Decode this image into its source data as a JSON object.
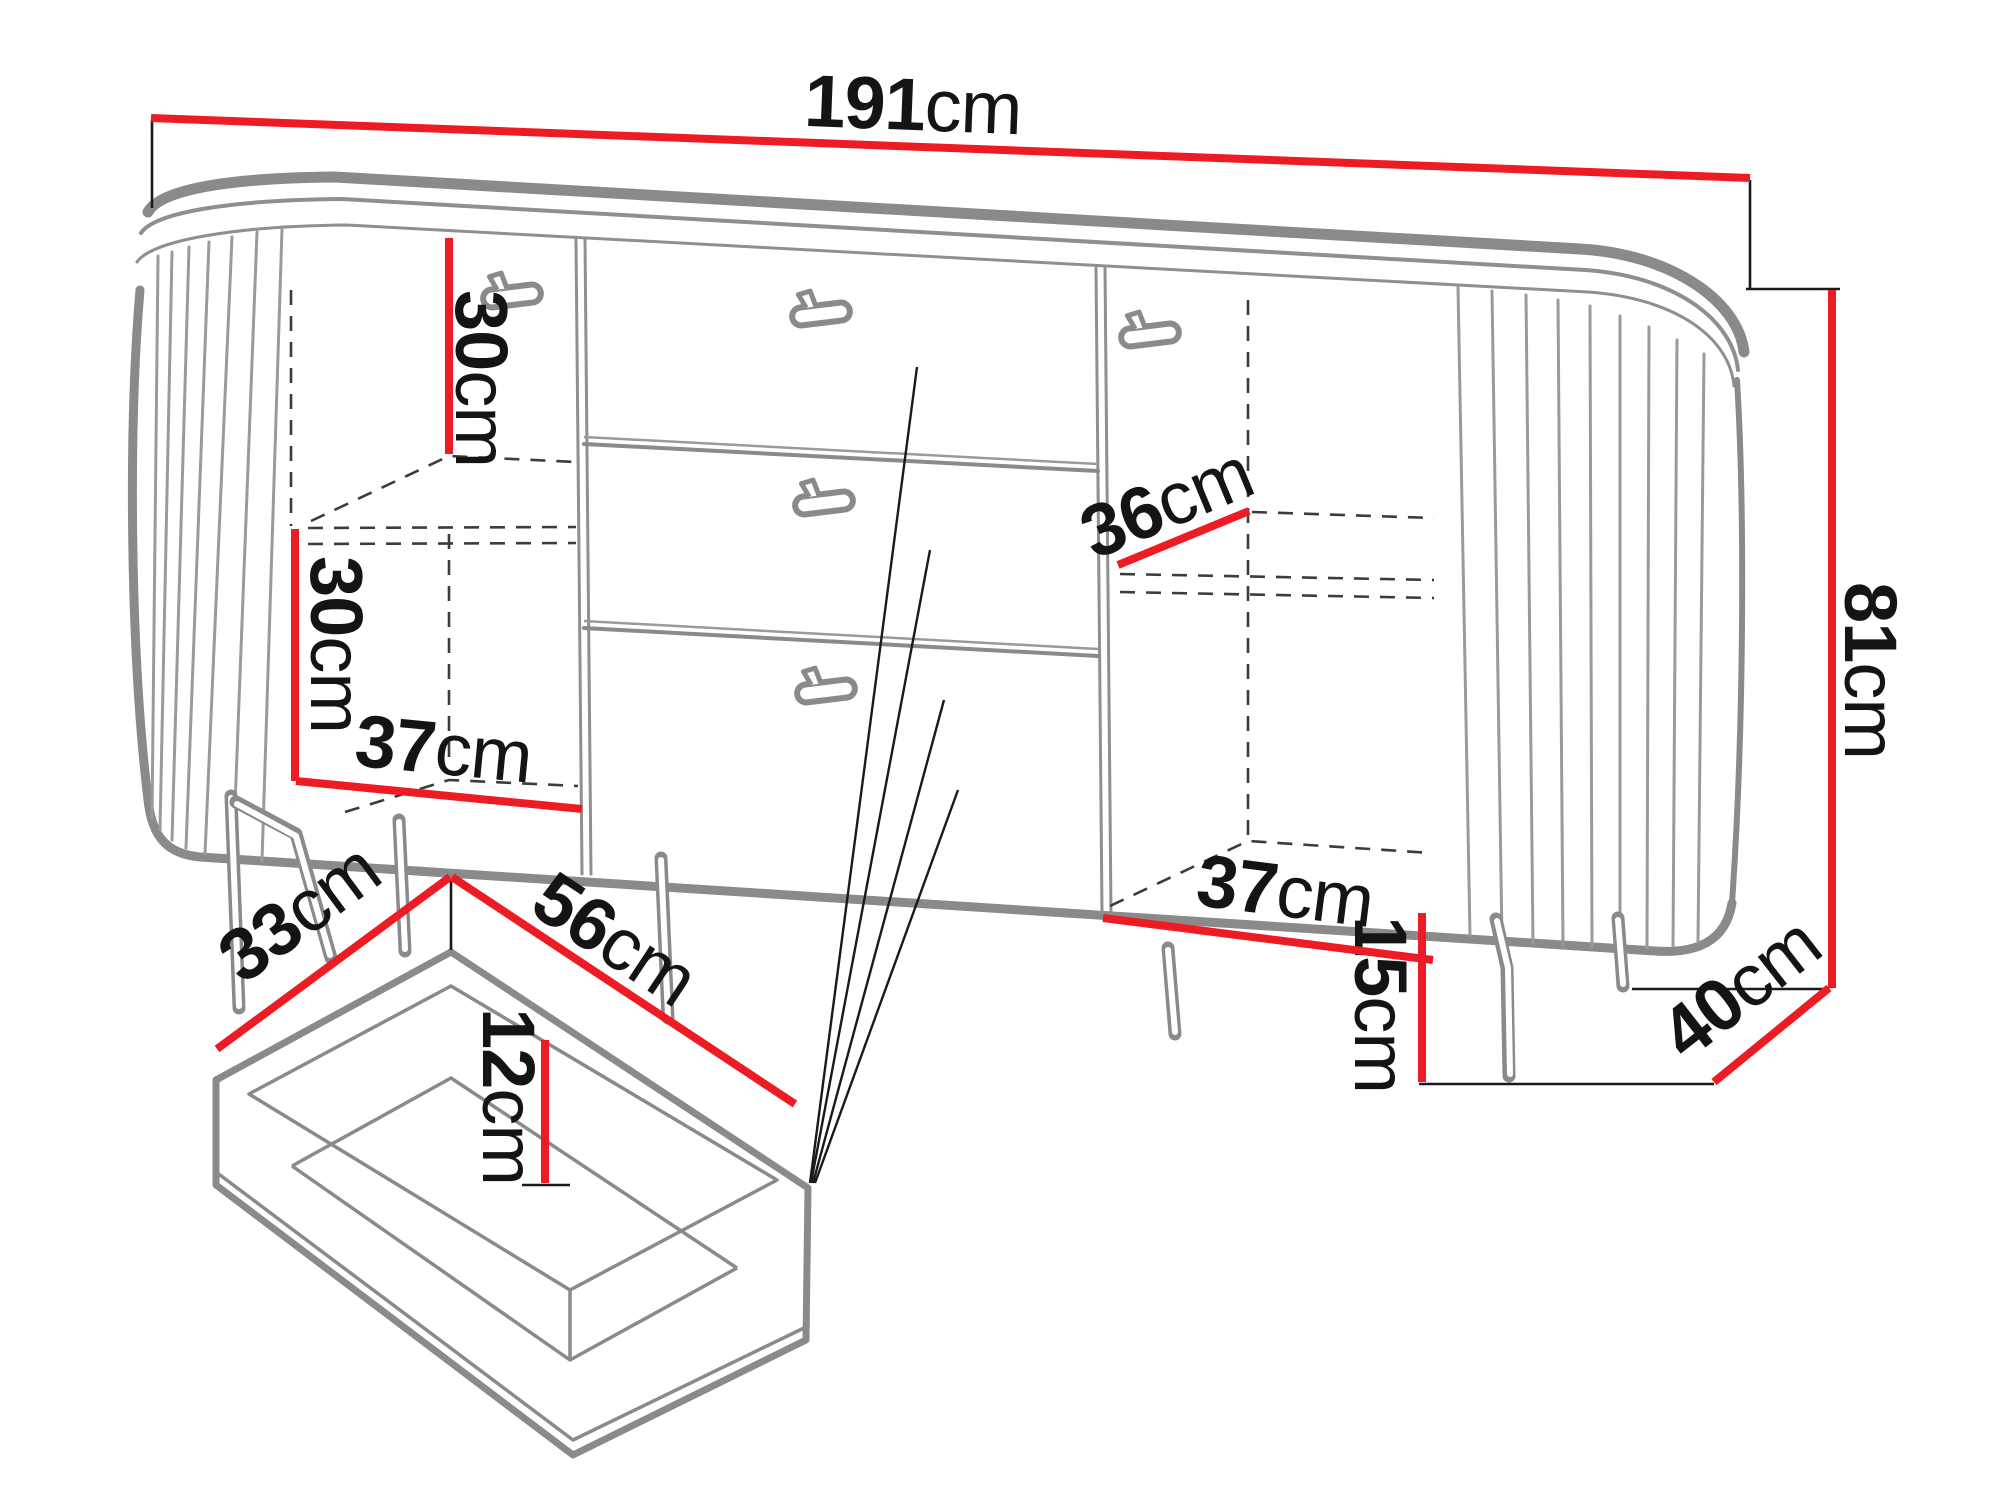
{
  "diagram": {
    "subject": "sideboard dimension drawing",
    "style": "technical line drawing with red dimension lines",
    "colors": {
      "dimension_line": "#ed1c24",
      "furniture_outline": "#8a8a8a",
      "label_text": "#141414",
      "background": "#ffffff"
    },
    "labels": {
      "overall_width": {
        "value": "191",
        "unit": "cm"
      },
      "overall_height": {
        "value": "81",
        "unit": "cm"
      },
      "overall_depth": {
        "value": "40",
        "unit": "cm"
      },
      "leg_height": {
        "value": "15",
        "unit": "cm"
      },
      "left_upper_compartment_height": {
        "value": "30",
        "unit": "cm"
      },
      "left_lower_compartment_height": {
        "value": "30",
        "unit": "cm"
      },
      "left_compartment_width": {
        "value": "37",
        "unit": "cm"
      },
      "right_shelf_depth": {
        "value": "36",
        "unit": "cm"
      },
      "right_compartment_width": {
        "value": "37",
        "unit": "cm"
      },
      "drawer_inner_depth": {
        "value": "33",
        "unit": "cm"
      },
      "drawer_inner_width": {
        "value": "56",
        "unit": "cm"
      },
      "drawer_inner_height": {
        "value": "12",
        "unit": "cm"
      }
    }
  }
}
